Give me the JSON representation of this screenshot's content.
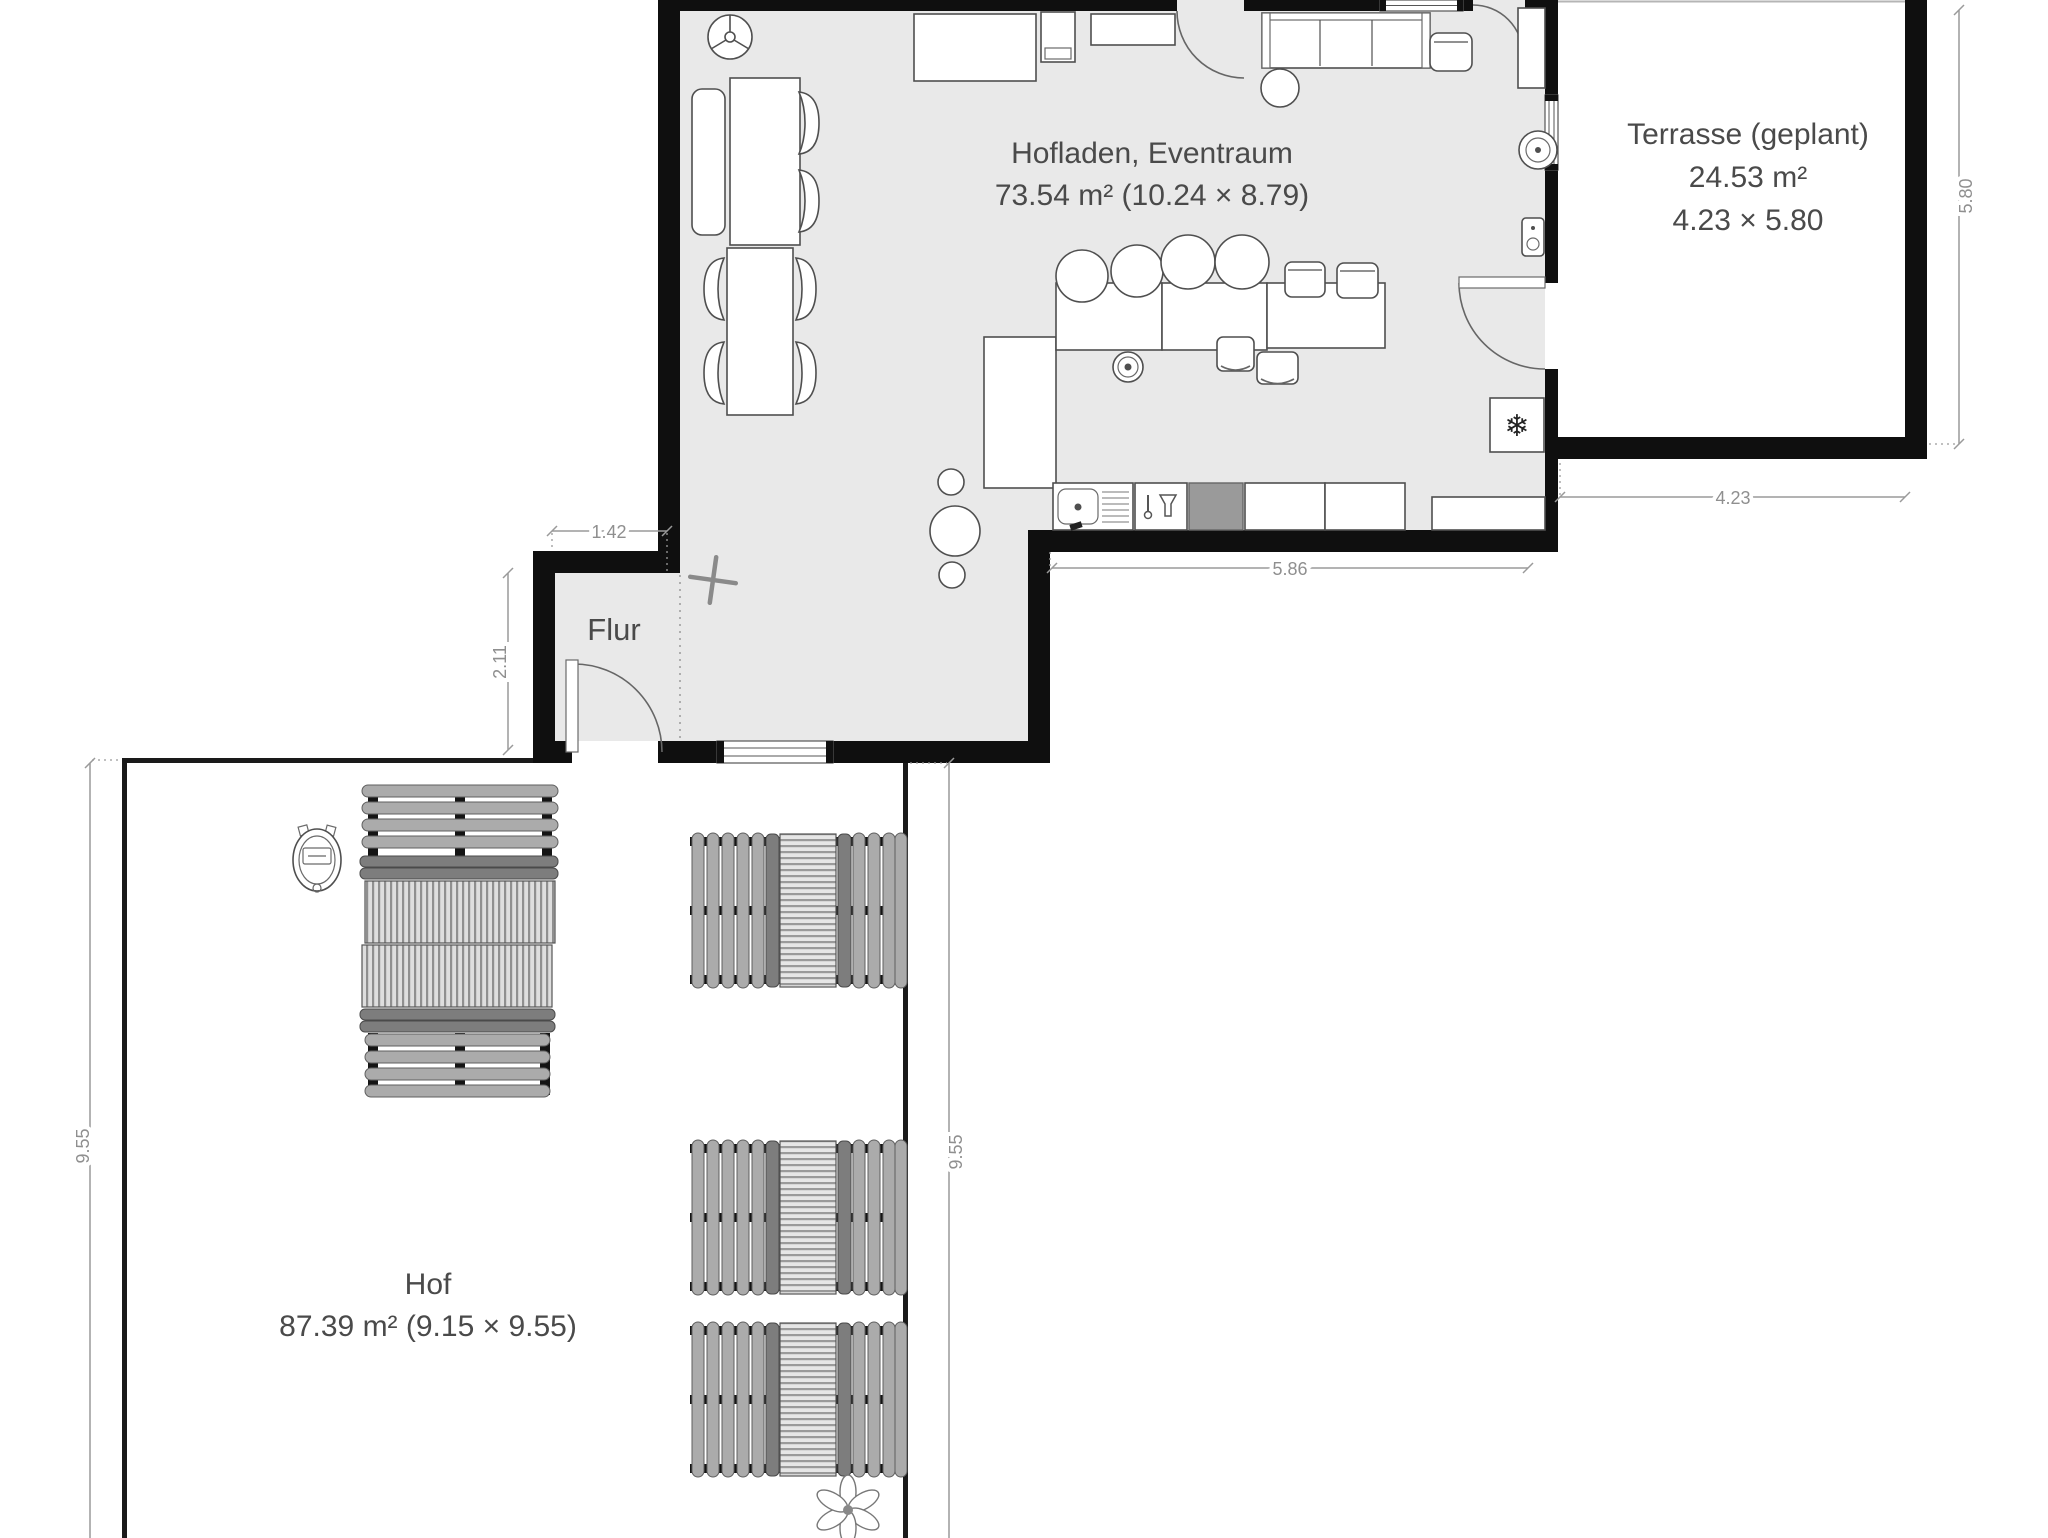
{
  "plan": {
    "rooms": [
      {
        "id": "hofladen",
        "name": "Hofladen, Eventraum",
        "area_text": "73.54 m² (10.24 × 8.79)"
      },
      {
        "id": "terrasse",
        "name": "Terrasse (geplant)",
        "area_text": "24.53 m²",
        "size_text": "4.23 × 5.80"
      },
      {
        "id": "flur",
        "name": "Flur"
      },
      {
        "id": "hof",
        "name": "Hof",
        "area_text": "87.39 m² (9.15 × 9.55)"
      }
    ],
    "dimensions": {
      "flur_width": "1.42",
      "flur_height": "2.11",
      "kitchen_wall": "5.86",
      "terrasse_width": "4.23",
      "terrasse_height": "5.80",
      "hof_left": "9.55",
      "hof_right": "9.55"
    },
    "icons": {
      "freezer_glyph": "❄"
    },
    "colors": {
      "floor": "#e9e9e9",
      "wall": "#0f0f0f",
      "furniture_stroke": "#4f4f4f",
      "appliance_grey": "#9a9a9a",
      "dim_grey": "#8f8f8f",
      "label_grey": "#4a4a4a",
      "hof_line": "#1a1a1a"
    }
  }
}
